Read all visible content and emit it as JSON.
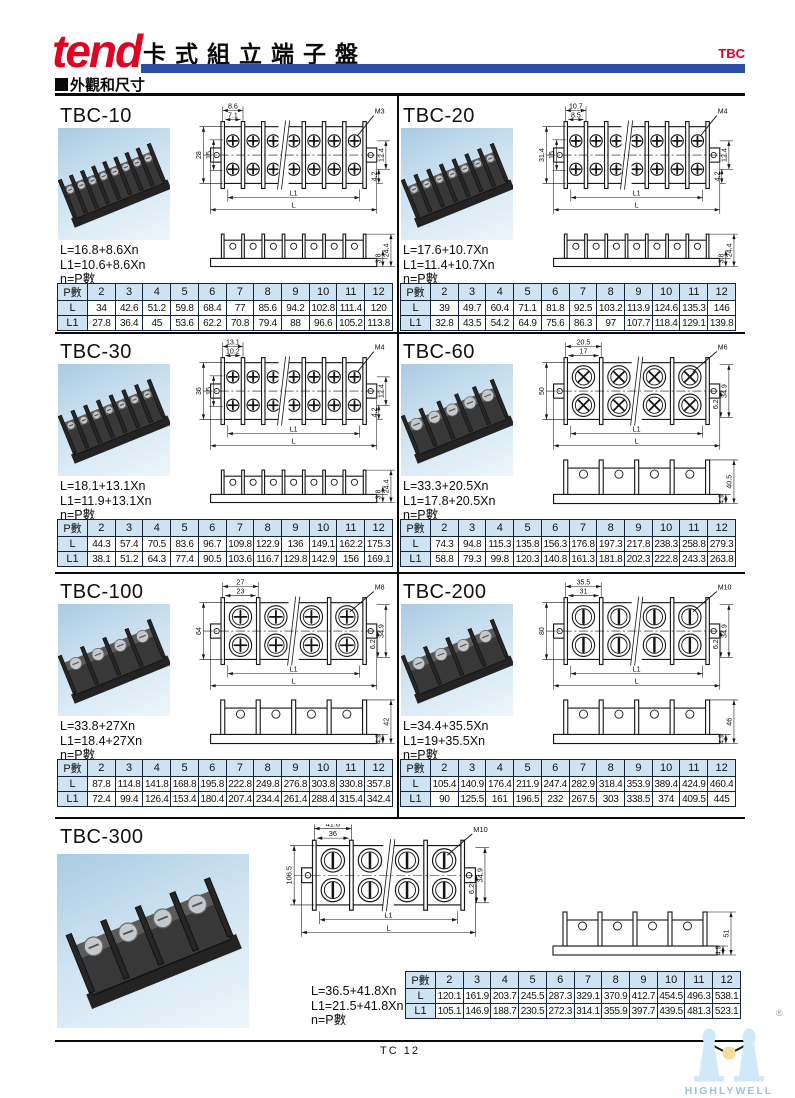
{
  "header": {
    "logo": "tend",
    "title": "卡式組立端子盤",
    "series_code": "TBC",
    "section_label": "外觀和尺寸",
    "accent_blue": "#2b4da4",
    "brand_red": "#df0421"
  },
  "footer": {
    "page_label": "TC 12",
    "watermark": "HIGHLYWELL",
    "registered": "®"
  },
  "table_header": [
    "P數",
    "2",
    "3",
    "4",
    "5",
    "6",
    "7",
    "8",
    "9",
    "10",
    "11",
    "12"
  ],
  "row_labels": [
    "L",
    "L1"
  ],
  "sections": [
    {
      "title": "TBC-10",
      "formulas": [
        "L=16.8+8.6Xn",
        "L1=10.6+8.6Xn",
        "n=P數"
      ],
      "dims": {
        "top_outer": "8.6",
        "top_inner": "7.1",
        "screw": "M3",
        "left_total": "28",
        "left_inner": "15",
        "right_a": "12.4",
        "right_b": "4.2",
        "len_inner": "L1",
        "len_outer": "L",
        "side_a": "3.8",
        "side_b": "24.4"
      },
      "rows": {
        "L": [
          "34",
          "42.6",
          "51.2",
          "59.8",
          "68.4",
          "77",
          "85.6",
          "94.2",
          "102.8",
          "111.4",
          "120"
        ],
        "L1": [
          "27.8",
          "36.4",
          "45",
          "53.6",
          "62.2",
          "70.8",
          "79.4",
          "88",
          "96.6",
          "105.2",
          "113.8"
        ]
      }
    },
    {
      "title": "TBC-20",
      "formulas": [
        "L=17.6+10.7Xn",
        "L1=11.4+10.7Xn",
        "n=P數"
      ],
      "dims": {
        "top_outer": "10.7",
        "top_inner": "8.5",
        "screw": "M4",
        "left_total": "31.4",
        "left_inner": "15",
        "right_a": "12.4",
        "right_b": "4.2",
        "len_inner": "L1",
        "len_outer": "L",
        "side_a": "3.8",
        "side_b": "24.4"
      },
      "rows": {
        "L": [
          "39",
          "49.7",
          "60.4",
          "71.1",
          "81.8",
          "92.5",
          "103.2",
          "113.9",
          "124.6",
          "135.3",
          "146"
        ],
        "L1": [
          "32.8",
          "43.5",
          "54.2",
          "64.9",
          "75.6",
          "86.3",
          "97",
          "107.7",
          "118.4",
          "129.1",
          "139.8"
        ]
      }
    },
    {
      "title": "TBC-30",
      "formulas": [
        "L=18.1+13.1Xn",
        "L1=11.9+13.1Xn",
        "n=P數"
      ],
      "dims": {
        "top_outer": "13.1",
        "top_inner": "10.2",
        "screw": "M4",
        "left_total": "36",
        "left_inner": "15",
        "right_a": "12.4",
        "right_b": "4.2",
        "len_inner": "L1",
        "len_outer": "L",
        "side_a": "3.8",
        "side_b": "24.4"
      },
      "rows": {
        "L": [
          "44.3",
          "57.4",
          "70.5",
          "83.6",
          "96.7",
          "109.8",
          "122.9",
          "136",
          "149.1",
          "162.2",
          "175.3"
        ],
        "L1": [
          "38.1",
          "51.2",
          "64.3",
          "77.4",
          "90.5",
          "103.6",
          "116.7",
          "129.8",
          "142.9",
          "156",
          "169.1"
        ]
      }
    },
    {
      "title": "TBC-60",
      "formulas": [
        "L=33.3+20.5Xn",
        "L1=17.8+20.5Xn",
        "n=P數"
      ],
      "dims": {
        "top_outer": "20.5",
        "top_inner": "17",
        "screw": "M6",
        "left_total": "50",
        "right_a": "34.9",
        "right_b": "6.2",
        "len_inner": "L1",
        "len_outer": "L",
        "side_a": "4.9",
        "side_b": "40.5"
      },
      "rows": {
        "L": [
          "74.3",
          "94.8",
          "115.3",
          "135.8",
          "156.3",
          "176.8",
          "197.3",
          "217.8",
          "238.3",
          "258.8",
          "279.3"
        ],
        "L1": [
          "58.8",
          "79.3",
          "99.8",
          "120.3",
          "140.8",
          "161.3",
          "181.8",
          "202.3",
          "222.8",
          "243.3",
          "263.8"
        ]
      }
    },
    {
      "title": "TBC-100",
      "formulas": [
        "L=33.8+27Xn",
        "L1=18.4+27Xn",
        "n=P數"
      ],
      "dims": {
        "top_outer": "27",
        "top_inner": "23",
        "screw": "M8",
        "left_total": "64",
        "right_a": "34.9",
        "right_b": "6.2",
        "len_inner": "L1",
        "len_outer": "L",
        "side_a": "4.9",
        "side_b": "42"
      },
      "rows": {
        "L": [
          "87.8",
          "114.8",
          "141.8",
          "168.8",
          "195.8",
          "222.8",
          "249.8",
          "276.8",
          "303.8",
          "330.8",
          "357.8"
        ],
        "L1": [
          "72.4",
          "99.4",
          "126.4",
          "153.4",
          "180.4",
          "207.4",
          "234.4",
          "261.4",
          "288.4",
          "315.4",
          "342.4"
        ]
      }
    },
    {
      "title": "TBC-200",
      "formulas": [
        "L=34.4+35.5Xn",
        "L1=19+35.5Xn",
        "n=P數"
      ],
      "dims": {
        "top_outer": "35.5",
        "top_inner": "31",
        "screw": "M10",
        "left_total": "80",
        "right_a": "34.9",
        "right_b": "6.2",
        "len_inner": "L1",
        "len_outer": "L",
        "side_a": "4.9",
        "side_b": "46"
      },
      "rows": {
        "L": [
          "105.4",
          "140.9",
          "176.4",
          "211.9",
          "247.4",
          "282.9",
          "318.4",
          "353.9",
          "389.4",
          "424.9",
          "460.4"
        ],
        "L1": [
          "90",
          "125.5",
          "161",
          "196.5",
          "232",
          "267.5",
          "303",
          "338.5",
          "374",
          "409.5",
          "445"
        ]
      }
    },
    {
      "title": "TBC-300",
      "formulas": [
        "L=36.5+41.8Xn",
        "L1=21.5+41.8Xn",
        "n=P數"
      ],
      "dims": {
        "top_outer": "41.8",
        "top_inner": "36",
        "screw": "M10",
        "left_total": "106.5",
        "right_a": "34.9",
        "right_b": "6.2",
        "len_inner": "L1",
        "len_outer": "L",
        "side_a": "4.9",
        "side_b": "51"
      },
      "rows": {
        "L": [
          "120.1",
          "161.9",
          "203.7",
          "245.5",
          "287.3",
          "329.1",
          "370.9",
          "412.7",
          "454.5",
          "496.3",
          "538.1"
        ],
        "L1": [
          "105.1",
          "146.9",
          "188.7",
          "230.5",
          "272.3",
          "314.1",
          "355.9",
          "397.7",
          "439.5",
          "481.3",
          "523.1"
        ]
      }
    }
  ]
}
